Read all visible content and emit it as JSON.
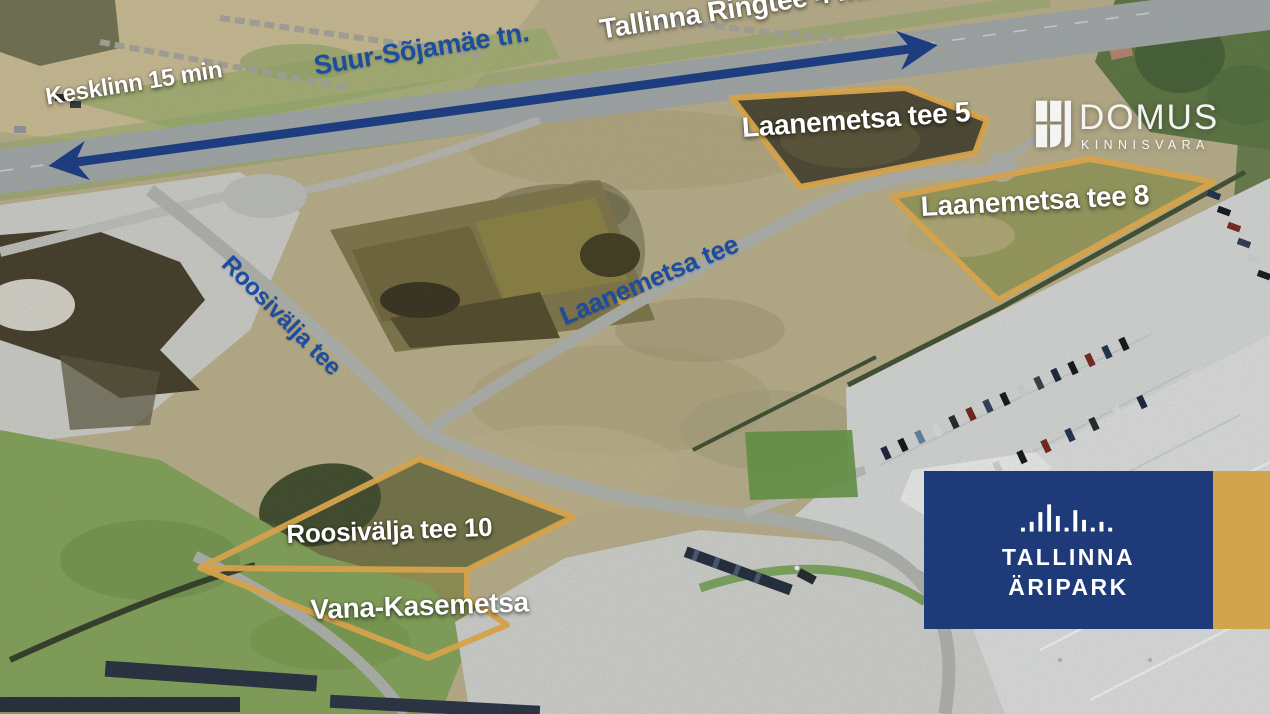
{
  "route_labels": {
    "kesklinn": "Kesklinn 15 min",
    "suur_sojamae": "Suur-Sõjamäe tn.",
    "tallinna_ringtee": "Tallinna Ringtee 4 min",
    "laanemetsa_tee": "Laanemetsa tee",
    "roosivalja_tee": "Roosivälja tee"
  },
  "plot_labels": {
    "laanemetsa_5": "Laanemetsa tee 5",
    "laanemetsa_8": "Laanemetsa tee 8",
    "roosivalja_10": "Roosivälja tee 10",
    "vana_kasemetsa": "Vana-Kasemetsa"
  },
  "branding": {
    "domus_name": "DOMUS",
    "domus_subtitle": "KINNISVARA",
    "aripark_line1": "TALLINNA",
    "aripark_line2": "ÄRIPARK"
  },
  "icons": {
    "domus_mark": "window-panes-logo",
    "aripark_mark": "skyline-bars-logo",
    "route_arrow": "double-headed-arrow"
  },
  "colors": {
    "arrow_navy": "#1e3d80",
    "road_label_blue": "#1d4da0",
    "plot_outline_gold": "#d4a24c",
    "brand_navy_box": "#1e3a78",
    "brand_gold_box": "#d2a44e",
    "label_white": "#ffffff"
  }
}
